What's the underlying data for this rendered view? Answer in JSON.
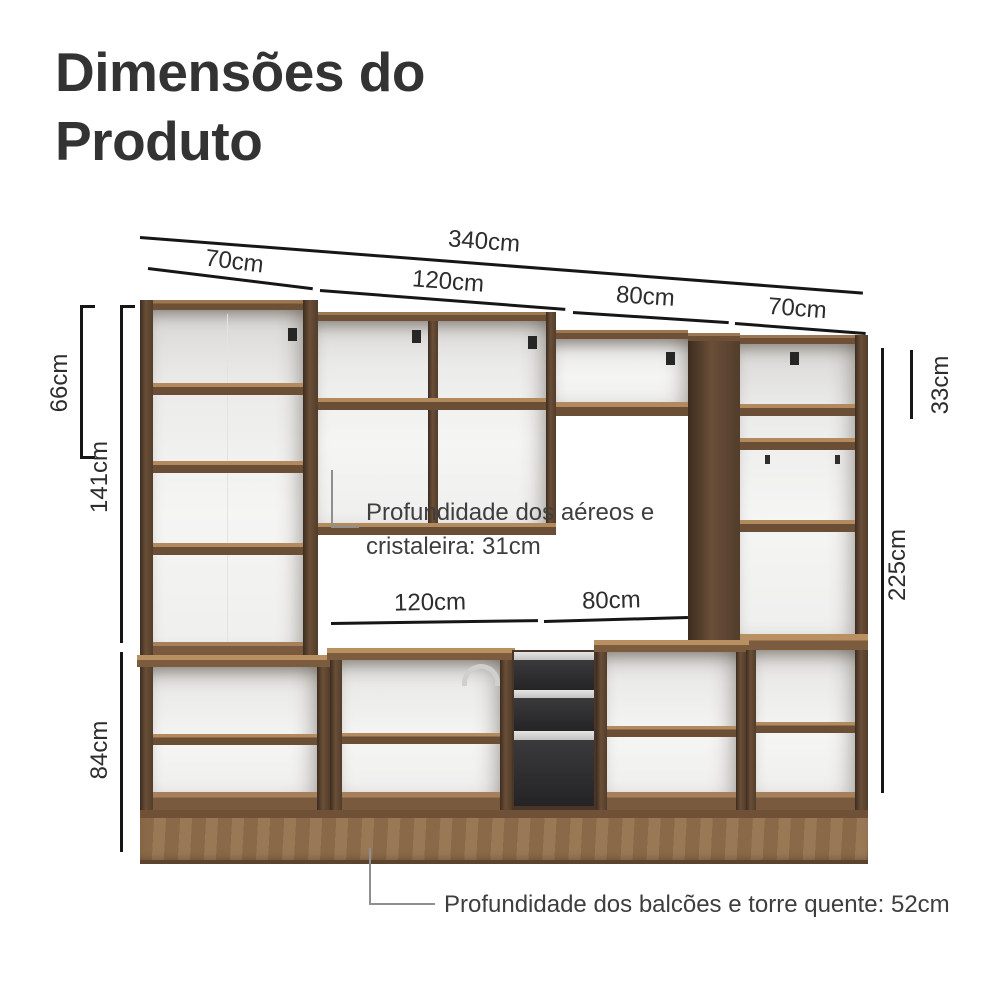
{
  "title": {
    "line1": "Dimensões do",
    "line2": "Produto"
  },
  "dimensions": {
    "total_width": "340cm",
    "top_section_1": "70cm",
    "top_section_2": "120cm",
    "top_section_3": "80cm",
    "top_section_4": "70cm",
    "upper_cabinet_height": "66cm",
    "left_tower_upper_height": "141cm",
    "base_height": "84cm",
    "right_upper_compartment_height": "33cm",
    "total_height": "225cm",
    "counter_section_1": "120cm",
    "counter_section_2": "80cm"
  },
  "annotations": {
    "upper_depth_line1": "Profundidade dos aéreos e",
    "upper_depth_line2": "cristaleira: 31cm",
    "base_depth": "Profundidade dos balcões e torre quente: 52cm"
  },
  "colors": {
    "title_text": "#333333",
    "dimension_line": "#161616",
    "dimension_text": "#2d2d2d",
    "note_text": "#3e3e3e",
    "leader_gray": "#8f8f8f",
    "wood_light": "#a5805a",
    "wood_mid": "#8a6847",
    "wood_dark": "#5a4430",
    "interior_white": "#f3f3f2",
    "drawer_black": "#2e2e30",
    "handle_silver": "#d6d6d4"
  }
}
